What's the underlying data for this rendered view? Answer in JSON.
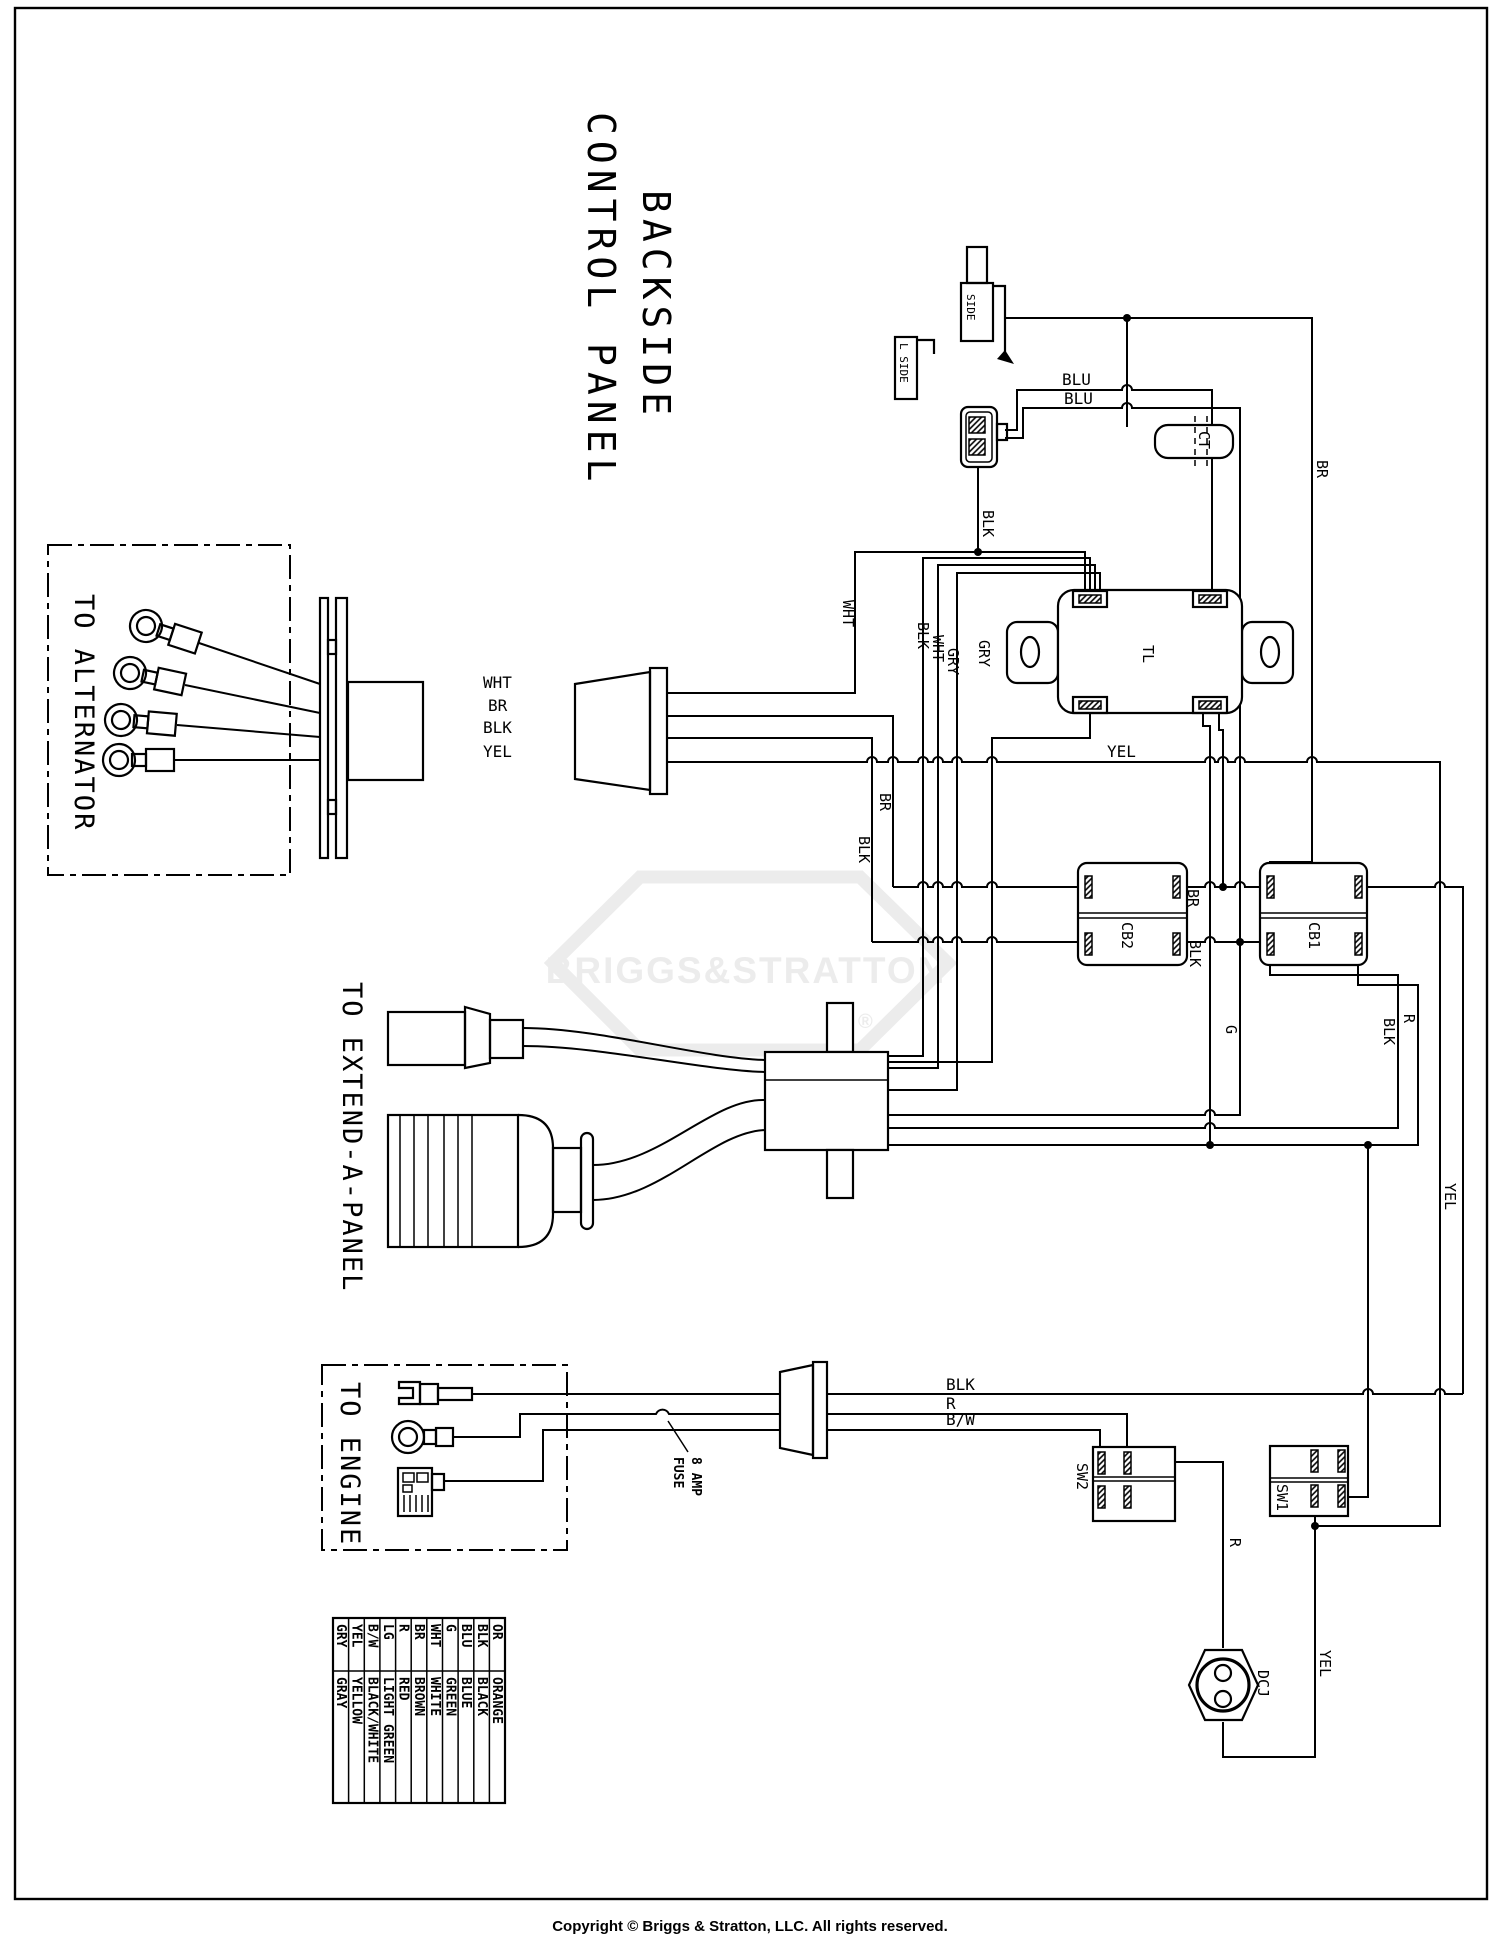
{
  "title": {
    "line1": "BACKSIDE",
    "line2": "CONTROL PANEL"
  },
  "sections": {
    "alternator": "TO ALTERNATOR",
    "extend_panel": "TO EXTEND-A-PANEL",
    "engine": "TO ENGINE"
  },
  "components": {
    "ct": "CT",
    "tl": "TL",
    "cb1": "CB1",
    "cb2": "CB2",
    "sw1": "SW1",
    "sw2": "SW2",
    "dcj": "DCJ",
    "side_plug": "SIDE",
    "l_side": "L SIDE",
    "fuse_line1": "8 AMP",
    "fuse_line2": "FUSE"
  },
  "wire_labels": {
    "bus_wht": "WHT",
    "bus_br": "BR",
    "bus_blk": "BLK",
    "bus_yel": "YEL",
    "riser_wht": "WHT",
    "riser_blk": "BLK",
    "riser_wht2": "WHT",
    "riser_gry": "GRY",
    "riser_gry2": "GRY",
    "riser_blk_conn": "BLK",
    "blu_top": "BLU",
    "blu_bottom": "BLU",
    "br_right": "BR",
    "yel_mid": "YEL",
    "cb_br": "BR",
    "cb_blk": "BLK",
    "g_wire": "G",
    "blk_right": "BLK",
    "r_right": "R",
    "yel_right": "YEL",
    "eng_blk": "BLK",
    "eng_r": "R",
    "eng_bw": "B/W",
    "r_dcj": "R",
    "yel_dcj": "YEL"
  },
  "legend": {
    "rows": [
      {
        "abbr": "OR",
        "name": "ORANGE"
      },
      {
        "abbr": "BLK",
        "name": "BLACK"
      },
      {
        "abbr": "BLU",
        "name": "BLUE"
      },
      {
        "abbr": "G",
        "name": "GREEN"
      },
      {
        "abbr": "WHT",
        "name": "WHITE"
      },
      {
        "abbr": "BR",
        "name": "BROWN"
      },
      {
        "abbr": "R",
        "name": "RED"
      },
      {
        "abbr": "LG",
        "name": "LIGHT GREEN"
      },
      {
        "abbr": "B/W",
        "name": "BLACK/WHITE"
      },
      {
        "abbr": "YEL",
        "name": "YELLOW"
      },
      {
        "abbr": "GRY",
        "name": "GRAY"
      }
    ]
  },
  "watermark": {
    "text": "BRIGGS&STRATTON",
    "registered": "®"
  },
  "footer": {
    "copyright": "Copyright © Briggs & Stratton, LLC. All rights reserved."
  },
  "colors": {
    "line": "#000000",
    "watermark": "#ececec",
    "background": "#ffffff"
  }
}
